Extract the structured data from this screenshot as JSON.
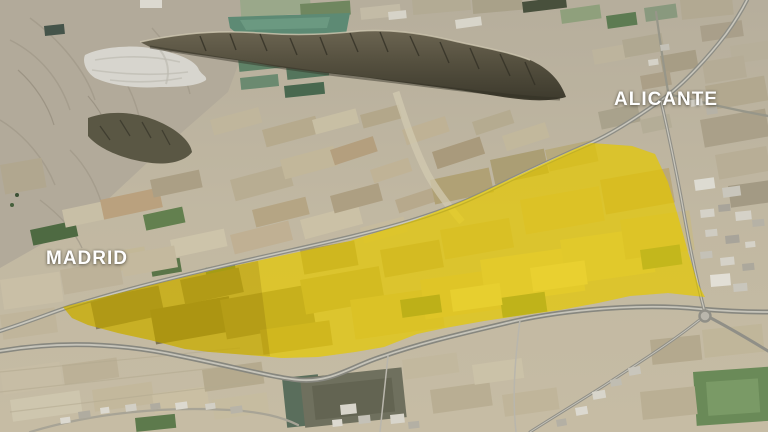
{
  "map": {
    "labels": [
      {
        "id": "madrid",
        "text": "MADRID"
      },
      {
        "id": "alicante",
        "text": "ALICANTE"
      }
    ],
    "label_color": "#ffffff",
    "highlight": {
      "color": "#f6e000",
      "shade_color": "#8a7a00",
      "points": "63,307 140,288 210,271 280,256 350,241 415,220 470,198 530,170 575,149 591,143 632,146 655,154 668,182 678,216 688,252 698,284 705,297 668,293 630,296 598,303 560,310 517,316 484,321 445,328 417,334 384,347 355,352 318,357 282,358 248,355 210,352 185,349 150,340 118,333 88,325 72,318",
      "shade_points": "63,307 140,288 215,270 258,261 270,356 248,355 210,352 185,349 150,340 118,333 88,325 72,318"
    }
  }
}
